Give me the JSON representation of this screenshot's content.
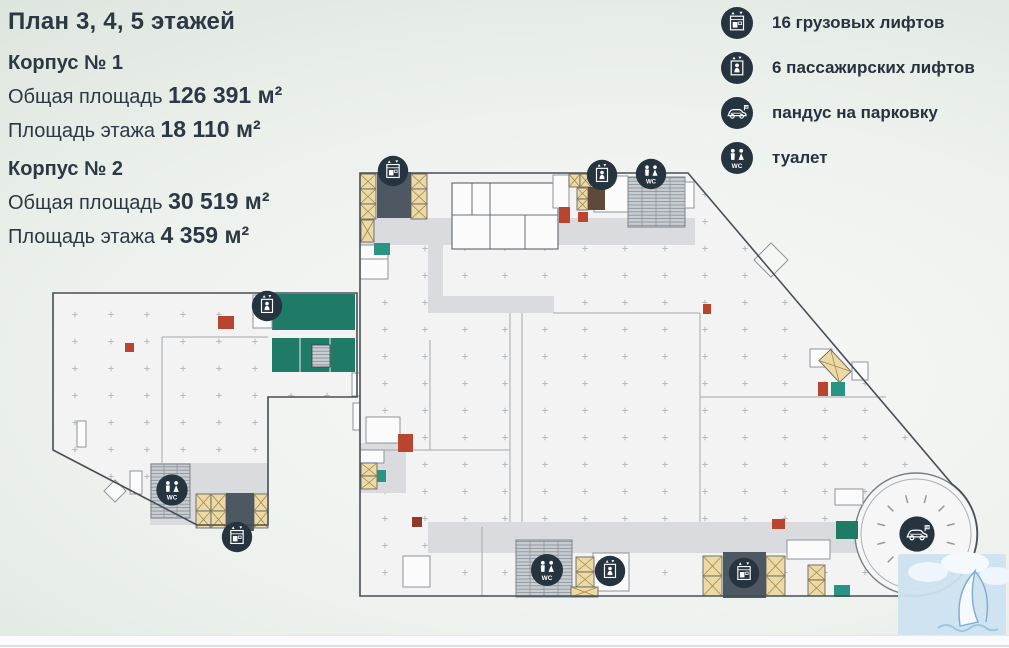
{
  "page": {
    "title": "План 3, 4, 5 этажей"
  },
  "buildings": [
    {
      "name": "Корпус № 1",
      "total_label": "Общая площадь",
      "total_value": "126 391 м²",
      "floor_label": "Площадь этажа",
      "floor_value": "18 110 м²"
    },
    {
      "name": "Корпус № 2",
      "total_label": "Общая площадь",
      "total_value": "30 519 м²",
      "floor_label": "Площадь этажа",
      "floor_value": "4 359 м²"
    }
  ],
  "legend": [
    {
      "icon": "freight-elevator-icon",
      "label": "16 грузовых лифтов"
    },
    {
      "icon": "passenger-elevator-icon",
      "label": "6 пассажирских лифтов"
    },
    {
      "icon": "parking-ramp-icon",
      "label": "пандус на парковку"
    },
    {
      "icon": "toilet-icon",
      "label": "туалет"
    }
  ],
  "plan": {
    "wc_label": "WC",
    "parking_letter": "P"
  },
  "colors": {
    "green_room": "#1f7a66",
    "icon_background": "#263440",
    "accent_red": "#b9442f",
    "elevator_yellow": "#ecd9a4",
    "corridor_gray": "#dbdcdf",
    "core_slate": "#4d5863"
  }
}
